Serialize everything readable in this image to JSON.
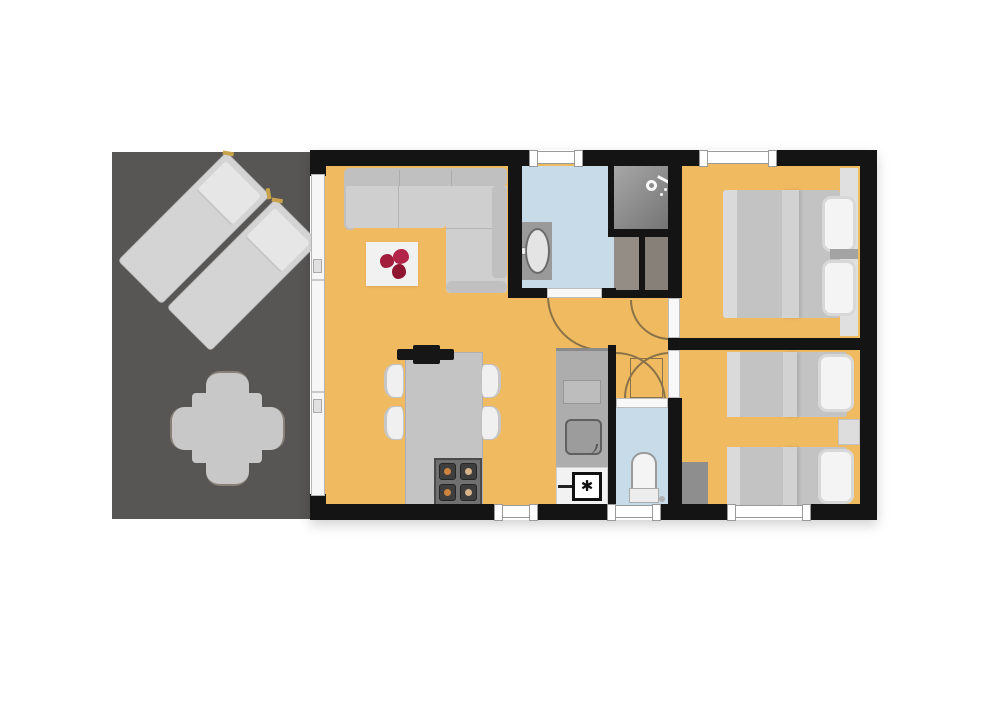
{
  "figure": {
    "type": "floor-plan",
    "description": "holiday-home floor plan with terrace",
    "boiler_symbol": "✱"
  },
  "colors": {
    "bg": "#ffffff",
    "wall": "#141414",
    "floor": "#f0ba60",
    "terrace": "#575655",
    "wet": "#c8dbe9",
    "glass": "#f6f6f6",
    "threshold": "#f8f8f8",
    "window": "#ffffff",
    "window_border": "#9a9a9a",
    "arc": "#8a7348",
    "sofa": "#cfcfcf",
    "sofa_dark": "#c0c0c0",
    "duvet": "#c3c3c3",
    "duvet_light": "#dadada",
    "duvet_crease": "#d2d2d2",
    "pillow": "#f4f4f4",
    "pillow_border": "#d8d8d8",
    "rug": "#f1f1f1",
    "flower1": "#a21c3c",
    "flower2": "#b32548",
    "flower3": "#8e1430",
    "shower_a": "#a8a8a8",
    "shower_b": "#6e6e6e",
    "closet_a": "#948d85",
    "closet_b": "#878078",
    "counter": "#adadad",
    "cabinet": "#bdbdbd",
    "island": "#c4c4c4",
    "stove": "#707070",
    "burner": "#3e3e3e",
    "flame": "#ce8440",
    "flame2": "#d9b48a",
    "appliance": "#f2f2f2",
    "black": "#161616",
    "headboard": "#e0e0e0",
    "wardrobe": "#8e8e8e",
    "tick": "#c8a34b",
    "chair": "#f0f0f0",
    "sink": "#9c9c9c",
    "sink_border": "#5f5f5f",
    "basin": "#e4e4e4",
    "basin_border": "#6a6a6a",
    "terrace_table": "#c8c8c8",
    "fixture_white": "#fafafa"
  },
  "rooms": [
    {
      "name": "terrace"
    },
    {
      "name": "living-room-kitchen"
    },
    {
      "name": "bathroom"
    },
    {
      "name": "shower"
    },
    {
      "name": "hallway"
    },
    {
      "name": "toilet"
    },
    {
      "name": "bedroom-double"
    },
    {
      "name": "bedroom-twin"
    }
  ],
  "furniture": [
    "sun-lounger",
    "sun-lounger",
    "outdoor-dining-set",
    "corner-sofa",
    "rug-with-flowers",
    "tv",
    "kitchen-island",
    "stove",
    "bar-chair",
    "kitchen-counter",
    "kitchen-sink",
    "boiler",
    "bathroom-sink",
    "shower-head",
    "closet",
    "closet",
    "toilet",
    "double-bed",
    "single-bed",
    "single-bed",
    "nightstand",
    "wardrobe",
    "sliding-glass-wall",
    "window",
    "interior-door"
  ]
}
